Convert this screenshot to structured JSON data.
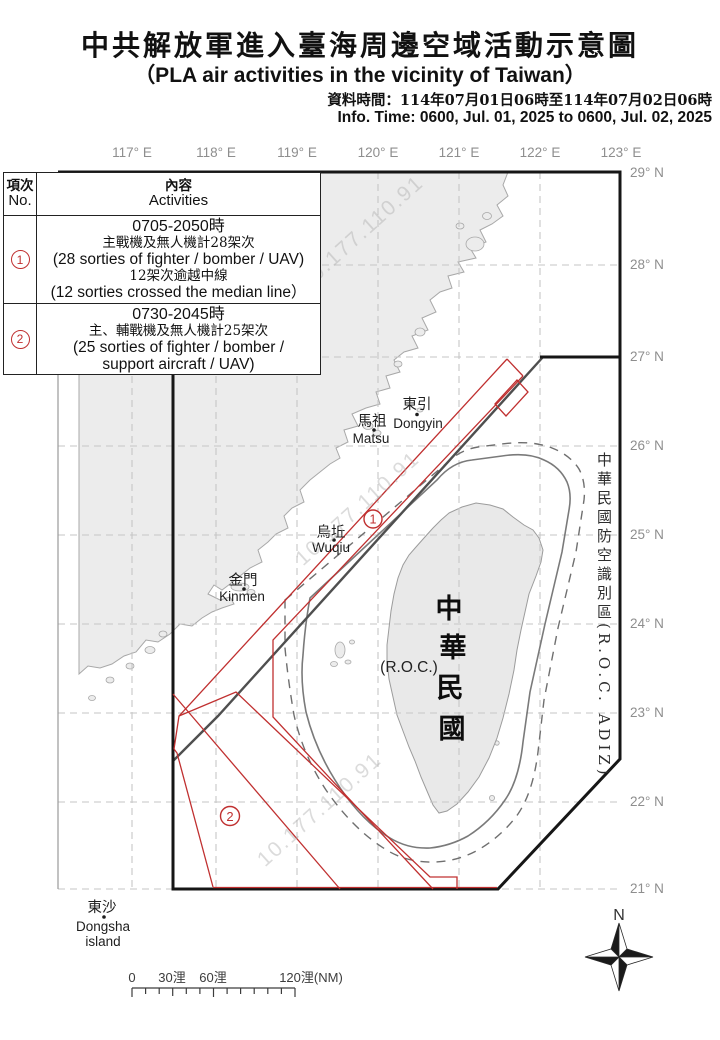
{
  "header": {
    "title_zh": "中共解放軍進入臺海周邊空域活動示意圖",
    "title_en": "（PLA air activities in the vicinity of Taiwan）",
    "info_zh": "資料時間：114年07月01日06時至114年07月02日06時",
    "info_en": "Info. Time: 0600, Jul. 01, 2025 to 0600, Jul. 02, 2025"
  },
  "table": {
    "col1_zh": "項次",
    "col1_en": "No.",
    "col2_zh": "內容",
    "col2_en": "Activities",
    "rows": [
      {
        "no": "1",
        "time": "0705-2050時",
        "zh1": "主戰機及無人機計28架次",
        "en1": "(28 sorties of fighter / bomber / UAV)",
        "zh2": "12架次逾越中線",
        "en2": "(12 sorties crossed the median line）"
      },
      {
        "no": "2",
        "time": "0730-2045時",
        "zh1": "主、輔戰機及無人機計25架次",
        "en1": "(25 sorties of fighter / bomber /",
        "en2": "support aircraft / UAV)"
      }
    ]
  },
  "map": {
    "lon_labels": [
      "117° E",
      "118° E",
      "119° E",
      "120° E",
      "121° E",
      "122° E",
      "123° E"
    ],
    "lat_labels": [
      "29° N",
      "28° N",
      "27° N",
      "26° N",
      "25° N",
      "24° N",
      "23° N",
      "22° N",
      "21° N"
    ],
    "adiz_label": "中華民國防空識別區(R.O.C. ADIZ)",
    "taiwan": {
      "char0": "中",
      "char1": "華",
      "char2": "民",
      "char3": "國",
      "roc": "(R.O.C.)"
    },
    "places": [
      {
        "zh": "東引",
        "en": "Dongyin"
      },
      {
        "zh": "馬祖",
        "en": "Matsu"
      },
      {
        "zh": "烏坵",
        "en": "Wuqiu"
      },
      {
        "zh": "金門",
        "en": "Kinmen"
      },
      {
        "zh": "東沙",
        "en": "Dongsha",
        "en2": "island"
      }
    ],
    "markers": [
      "1",
      "2"
    ],
    "watermark": "10.177.110.91",
    "compass": "N",
    "scale_labels": [
      "0",
      "30浬",
      "60浬",
      "120浬(NM)"
    ]
  },
  "colors": {
    "activity_red": "#c03030",
    "median_line": "#4f4f4f",
    "adiz_black": "#161616",
    "grid_gray": "#c6c6c6",
    "land_gray": "#ececec"
  }
}
